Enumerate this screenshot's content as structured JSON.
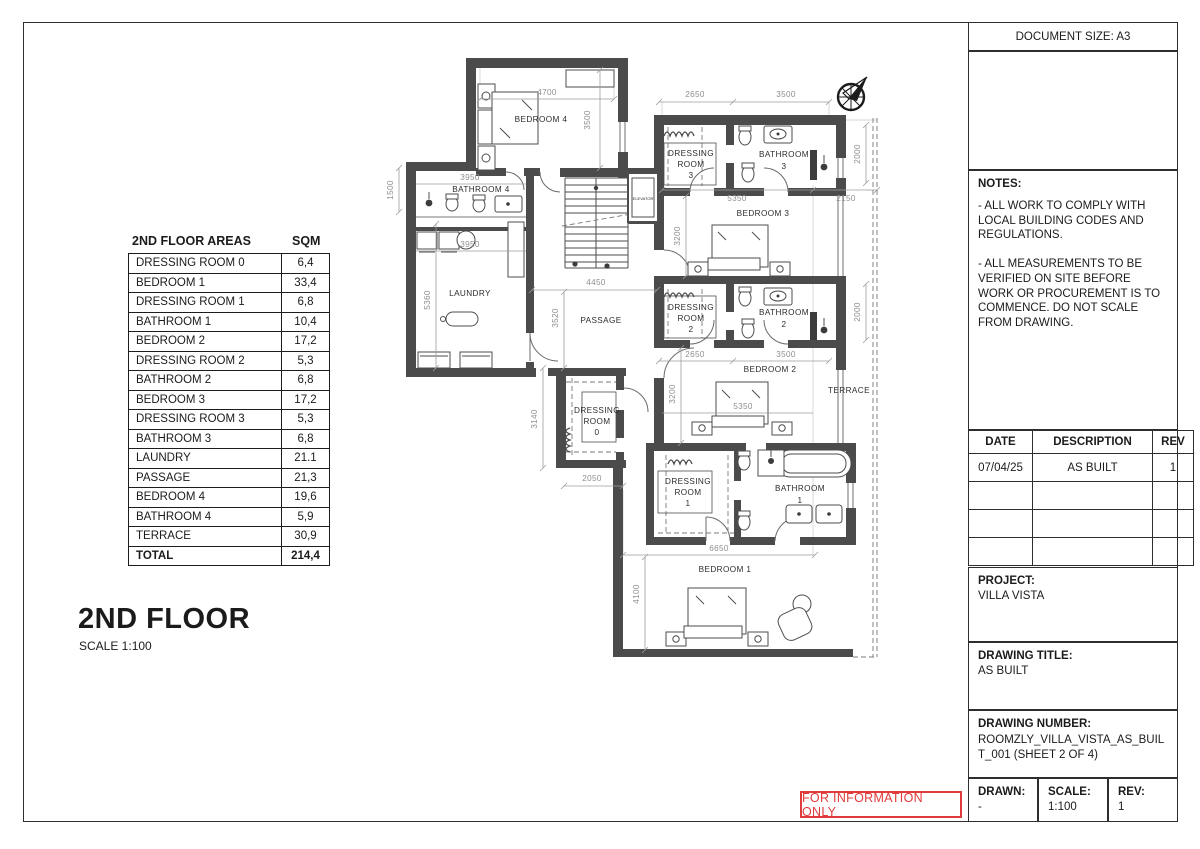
{
  "titleblock": {
    "document_size": "DOCUMENT SIZE: A3",
    "notes": {
      "title": "NOTES:",
      "para1": "- ALL WORK TO COMPLY WITH LOCAL BUILDING CODES AND REGULATIONS.",
      "para2": "- ALL MEASUREMENTS TO BE VERIFIED ON SITE BEFORE WORK OR PROCUREMENT IS TO COMMENCE. DO NOT SCALE FROM DRAWING."
    },
    "revisions": {
      "headers": [
        "DATE",
        "DESCRIPTION",
        "REV"
      ],
      "rows": [
        {
          "date": "07/04/25",
          "desc": "AS BUILT",
          "rev": "1"
        },
        {
          "date": "",
          "desc": "",
          "rev": ""
        },
        {
          "date": "",
          "desc": "",
          "rev": ""
        },
        {
          "date": "",
          "desc": "",
          "rev": ""
        }
      ]
    },
    "project": {
      "label": "PROJECT:",
      "value": "VILLA VISTA"
    },
    "drawing_title": {
      "label": "DRAWING TITLE:",
      "value": "AS BUILT"
    },
    "drawing_number": {
      "label": "DRAWING NUMBER:",
      "value": "ROOMZLY_VILLA_VISTA_AS_BUILT_001 (SHEET 2 OF 4)"
    },
    "drawn": {
      "label": "DRAWN:",
      "value": "-"
    },
    "scale": {
      "label": "SCALE:",
      "value": "1:100"
    },
    "rev": {
      "label": "REV:",
      "value": "1"
    }
  },
  "stamp": "FOR INFORMATION ONLY",
  "floor": {
    "title": "2ND FLOOR",
    "scale": "SCALE 1:100"
  },
  "areas": {
    "title": "2ND FLOOR AREAS",
    "unit_header": "SQM",
    "rows": [
      {
        "name": "DRESSING ROOM 0",
        "sqm": "6,4"
      },
      {
        "name": "BEDROOM 1",
        "sqm": "33,4"
      },
      {
        "name": "DRESSING ROOM 1",
        "sqm": "6,8"
      },
      {
        "name": "BATHROOM 1",
        "sqm": "10,4"
      },
      {
        "name": "BEDROOM 2",
        "sqm": "17,2"
      },
      {
        "name": "DRESSING ROOM 2",
        "sqm": "5,3"
      },
      {
        "name": "BATHROOM 2",
        "sqm": "6,8"
      },
      {
        "name": "BEDROOM 3",
        "sqm": "17,2"
      },
      {
        "name": "DRESSING ROOM 3",
        "sqm": "5,3"
      },
      {
        "name": "BATHROOM 3",
        "sqm": "6,8"
      },
      {
        "name": "LAUNDRY",
        "sqm": "21.1"
      },
      {
        "name": "PASSAGE",
        "sqm": "21,3"
      },
      {
        "name": "BEDROOM 4",
        "sqm": "19,6"
      },
      {
        "name": "BATHROOM 4",
        "sqm": "5,9"
      },
      {
        "name": "TERRACE",
        "sqm": "30,9"
      },
      {
        "name": "TOTAL",
        "sqm": "214,4"
      }
    ]
  },
  "plan": {
    "rooms": {
      "bedroom4": "BEDROOM 4",
      "bathroom4": "BATHROOM 4",
      "laundry": "LAUNDRY",
      "passage": "PASSAGE",
      "elevator": "ELEVATOR",
      "dressing3": [
        "DRESSING",
        "ROOM",
        "3"
      ],
      "bathroom3": [
        "BATHROOM",
        "3"
      ],
      "bedroom3": "BEDROOM 3",
      "dressing2": [
        "DRESSING",
        "ROOM",
        "2"
      ],
      "bathroom2": [
        "BATHROOM",
        "2"
      ],
      "bedroom2": "BEDROOM 2",
      "terrace": "TERRACE",
      "dressing0": [
        "DRESSING",
        "ROOM",
        "0"
      ],
      "dressing1": [
        "DRESSING",
        "ROOM",
        "1"
      ],
      "bathroom1": [
        "BATHROOM",
        "1"
      ],
      "bedroom1": "BEDROOM 1"
    },
    "dims": [
      "4700",
      "3500",
      "1500",
      "3950",
      "3950",
      "5360",
      "2650",
      "3500",
      "2000",
      "5350",
      "2150",
      "3200",
      "4450",
      "3520",
      "2650",
      "3500",
      "2000",
      "3200",
      "5350",
      "3140",
      "2050",
      "6650",
      "4100"
    ]
  }
}
